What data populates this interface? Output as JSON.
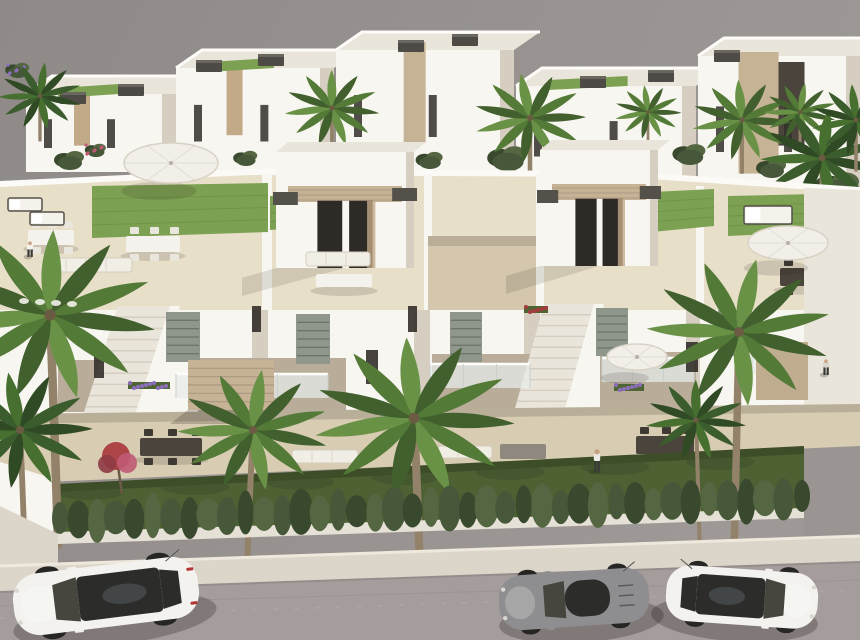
{
  "meta": {
    "description": "Aerial 3D architectural rendering of a modern white residential development: two rows of flat-roofed townhouses with rooftop solariums (artificial lawns, parasols, outdoor lounges, stone-clad stair towers with dark caps), palm trees and shrubs, a front garden strip behind a cypress hedge and white wall, a light sidewalk, and a gray street with three parked cars.",
    "visible_text": []
  },
  "palette": {
    "sky1": "#8f8a88",
    "sky2": "#9e9997",
    "wallSun": "#f8f6f0",
    "wallMid": "#eae5db",
    "wallShade": "#d5cec1",
    "wallDeep": "#b9ad9a",
    "tileSun": "#e8dfc9",
    "tileShade": "#d4c7ad",
    "terrace": "#d8ccb3",
    "lawnRoof": "#7da152",
    "lawnRoofDk": "#698b43",
    "lawnGround": "#4d6133",
    "lawnGroundDk": "#3e5029",
    "hedgeA": "#47583a",
    "hedgeB": "#39492e",
    "hedgeC": "#546742",
    "palmDark": "#41602e",
    "palmMid": "#547a38",
    "palmLight": "#6a9247",
    "palmDeep1": "#2f4a24",
    "palmDeep2": "#3b5c2c",
    "palmDeep3": "#477030",
    "trunk": "#93826a",
    "stone": "#c6b295",
    "stoneDk": "#a6917a",
    "cap": "#54504a",
    "wood": "#c2a987",
    "glass": "#332f2a",
    "shutter": "#8f968b",
    "shutterDk": "#6d746a",
    "flowerPurple": "#8e6ec2",
    "flowerPink": "#c05a74",
    "flowerRed": "#a93a3e",
    "flowerWhite": "#f2f0ea",
    "sidewalk": "#dcd6ca",
    "curb": "#efe9dd",
    "road": "#a49d9c",
    "roadDk": "#958d8c",
    "carWhite": "#f3f2ee",
    "carGray": "#8e8d8f",
    "carGlass": "#2c2d2b",
    "wheel": "#262624",
    "skin": "#c9a184"
  },
  "villas": [
    {
      "x": 26,
      "top": 76,
      "w": 150,
      "h": 96,
      "accent": "wood",
      "lawn": true
    },
    {
      "x": 176,
      "top": 50,
      "w": 158,
      "h": 122,
      "accent": "wood",
      "lawn": true
    },
    {
      "x": 336,
      "top": 32,
      "w": 178,
      "h": 140,
      "accent": "stone",
      "lawn": false
    },
    {
      "x": 516,
      "top": 68,
      "w": 180,
      "h": 118,
      "accent": "none",
      "lawn": true
    },
    {
      "x": 698,
      "top": 38,
      "w": 162,
      "h": 152,
      "accent": "stone-big",
      "lawn": false
    }
  ],
  "ac_units": [
    {
      "x": 118,
      "y": 84
    },
    {
      "x": 196,
      "y": 60
    },
    {
      "x": 258,
      "y": 54
    },
    {
      "x": 398,
      "y": 40
    },
    {
      "x": 452,
      "y": 34
    },
    {
      "x": 580,
      "y": 76
    },
    {
      "x": 648,
      "y": 70
    },
    {
      "x": 714,
      "y": 50
    },
    {
      "x": 60,
      "y": 92
    }
  ],
  "shrubs": [
    {
      "x": 70,
      "y": 160,
      "s": 1.0
    },
    {
      "x": 162,
      "y": 154,
      "s": 1.2
    },
    {
      "x": 246,
      "y": 158,
      "s": 0.8
    },
    {
      "x": 325,
      "y": 152,
      "s": 1.0
    },
    {
      "x": 430,
      "y": 160,
      "s": 0.9
    },
    {
      "x": 508,
      "y": 158,
      "s": 1.3
    },
    {
      "x": 600,
      "y": 162,
      "s": 0.9
    },
    {
      "x": 690,
      "y": 154,
      "s": 1.1
    },
    {
      "x": 772,
      "y": 168,
      "s": 1.0
    },
    {
      "x": 838,
      "y": 186,
      "s": 1.5
    },
    {
      "x": 18,
      "y": 70,
      "s": 0.8,
      "flower": "flowerPurple"
    },
    {
      "x": 96,
      "y": 150,
      "s": 0.7,
      "flower": "flowerPink"
    },
    {
      "x": 560,
      "y": 160,
      "s": 0.7,
      "flower": "flowerWhite"
    }
  ],
  "bg_palms": [
    {
      "x": 332,
      "cy": 108,
      "s": 0.85,
      "base": 170
    },
    {
      "x": 530,
      "cy": 118,
      "s": 1.0,
      "base": 205
    },
    {
      "x": 648,
      "cy": 112,
      "s": 0.6,
      "base": 150
    },
    {
      "x": 742,
      "cy": 120,
      "s": 0.9,
      "base": 172
    },
    {
      "x": 800,
      "cy": 112,
      "s": 0.65,
      "base": 150
    },
    {
      "x": 40,
      "cy": 96,
      "s": 0.75,
      "base": 140,
      "dark": true
    },
    {
      "x": 822,
      "cy": 158,
      "s": 1.1,
      "base": 210,
      "dark": true
    },
    {
      "x": 856,
      "cy": 120,
      "s": 0.8,
      "base": 170,
      "dark": true
    }
  ],
  "fg_palms": [
    {
      "x": 58,
      "cy": 315,
      "s": 1.9,
      "base": 545,
      "lean": -8,
      "flowers": true
    },
    {
      "x": 24,
      "cy": 430,
      "s": 1.3,
      "base": 530,
      "lean": -4,
      "dark": true
    },
    {
      "x": 247,
      "cy": 430,
      "s": 1.35,
      "base": 572,
      "lean": 6
    },
    {
      "x": 420,
      "cy": 418,
      "s": 1.8,
      "base": 572,
      "lean": -6
    },
    {
      "x": 734,
      "cy": 332,
      "s": 1.65,
      "base": 556,
      "lean": 5
    },
    {
      "x": 700,
      "cy": 420,
      "s": 0.9,
      "base": 560,
      "lean": -4,
      "dark": true
    }
  ],
  "deck": {
    "lawns": [
      {
        "x": 92,
        "y": 186,
        "w": 176,
        "h": 52
      },
      {
        "x": 270,
        "y": 196,
        "w": 92,
        "h": 34
      },
      {
        "x": 652,
        "y": 192,
        "w": 62,
        "h": 40
      },
      {
        "x": 728,
        "y": 196,
        "w": 130,
        "h": 40
      }
    ],
    "towers": [
      {
        "x": 276,
        "y": 152,
        "w": 138,
        "h": 116
      },
      {
        "x": 540,
        "y": 150,
        "w": 118,
        "h": 116
      }
    ],
    "tables": [
      {
        "x": 126,
        "y": 236,
        "w": 54,
        "h": 16,
        "fill": "white",
        "chairs": "white"
      },
      {
        "x": 28,
        "y": 230,
        "w": 46,
        "h": 15,
        "fill": "white",
        "chairs": "white"
      },
      {
        "x": 316,
        "y": 274,
        "w": 56,
        "h": 13,
        "fill": "white",
        "chairs": null
      },
      {
        "x": 780,
        "y": 268,
        "w": 66,
        "h": 18,
        "fill": "dark",
        "chairs": "dark"
      }
    ],
    "sofas": [
      {
        "x": 46,
        "y": 258,
        "w": 86,
        "h": 14
      },
      {
        "x": 306,
        "y": 252,
        "w": 64,
        "h": 14
      },
      {
        "x": 792,
        "y": 232,
        "w": 64,
        "h": 13
      },
      {
        "x": 844,
        "y": 232,
        "w": 13,
        "h": 32
      }
    ],
    "daybeds": [
      {
        "x": 744,
        "y": 206,
        "w": 48,
        "h": 18
      },
      {
        "x": 8,
        "y": 198,
        "w": 34,
        "h": 13
      },
      {
        "x": 30,
        "y": 212,
        "w": 34,
        "h": 13
      }
    ],
    "umbrellas": [
      {
        "x": 171,
        "y": 163,
        "rx": 47,
        "ry": 20
      },
      {
        "x": 788,
        "y": 243,
        "rx": 40,
        "ry": 17
      },
      {
        "x": 637,
        "y": 357,
        "rx": 30,
        "ry": 13
      }
    ]
  },
  "facade": {
    "shutters": [
      {
        "x": 166,
        "y": 312,
        "w": 34,
        "h": 50
      },
      {
        "x": 296,
        "y": 314,
        "w": 34,
        "h": 50
      },
      {
        "x": 450,
        "y": 312,
        "w": 32,
        "h": 50
      },
      {
        "x": 596,
        "y": 308,
        "w": 32,
        "h": 48
      },
      {
        "x": 718,
        "y": 310,
        "w": 30,
        "h": 46
      }
    ],
    "slit_windows": [
      {
        "x": 94,
        "y": 346,
        "w": 10,
        "h": 32
      },
      {
        "x": 366,
        "y": 350,
        "w": 12,
        "h": 34
      },
      {
        "x": 686,
        "y": 342,
        "w": 12,
        "h": 30
      },
      {
        "x": 408,
        "y": 306,
        "w": 9,
        "h": 26
      },
      {
        "x": 252,
        "y": 306,
        "w": 9,
        "h": 26
      }
    ],
    "balconies": [
      {
        "x": 176,
        "y": 374,
        "w": 152,
        "h": 24
      },
      {
        "x": 430,
        "y": 364,
        "w": 100,
        "h": 24
      },
      {
        "x": 602,
        "y": 358,
        "w": 92,
        "h": 24
      },
      {
        "x": 752,
        "y": 352,
        "w": 70,
        "h": 22
      }
    ],
    "flower_boxes": [
      {
        "x": 128,
        "y": 382,
        "w": 42,
        "color": "flowerPurple"
      },
      {
        "x": 614,
        "y": 384,
        "w": 30,
        "color": "flowerPurple"
      },
      {
        "x": 524,
        "y": 306,
        "w": 24,
        "color": "flowerRed"
      },
      {
        "x": 770,
        "y": 344,
        "w": 24,
        "color": "flowerPink"
      }
    ]
  },
  "ground": {
    "canopy": {
      "x": 188,
      "y": 360,
      "w": 86,
      "h": 50
    },
    "tables": [
      {
        "x": 140,
        "y": 438,
        "w": 62,
        "h": 18
      },
      {
        "x": 636,
        "y": 436,
        "w": 58,
        "h": 18
      }
    ],
    "sofas": [
      {
        "x": 292,
        "y": 450,
        "w": 66,
        "h": 13
      },
      {
        "x": 438,
        "y": 446,
        "w": 54,
        "h": 12
      }
    ],
    "loungers": [
      {
        "x": 500,
        "y": 444,
        "w": 46,
        "h": 15
      }
    ]
  },
  "garden": {
    "tree": {
      "x": 116,
      "y": 456
    }
  },
  "hedge": {
    "x1": 60,
    "y1": 520,
    "x2": 802,
    "y2": 498,
    "count": 41
  },
  "people": [
    {
      "x": 597,
      "y": 450,
      "h": 22,
      "shirt": "#eceae4"
    },
    {
      "x": 826,
      "y": 360,
      "h": 15,
      "shirt": "#dad6ce"
    },
    {
      "x": 30,
      "y": 242,
      "h": 15,
      "shirt": "#f4f2ec"
    }
  ],
  "cars": [
    {
      "name": "white-suv",
      "type": "suv",
      "x": 106,
      "y": 596,
      "len": 186,
      "wid": 62,
      "rot": -7,
      "facing": "left",
      "body": "carWhite"
    },
    {
      "name": "gray-coupe",
      "type": "coupe",
      "x": 574,
      "y": 599,
      "len": 150,
      "wid": 55,
      "rot": -4,
      "facing": "left",
      "body": "carGray"
    },
    {
      "name": "white-sedan",
      "type": "sedan",
      "x": 742,
      "y": 597,
      "len": 152,
      "wid": 56,
      "rot": 4,
      "facing": "right",
      "body": "carWhite"
    }
  ]
}
